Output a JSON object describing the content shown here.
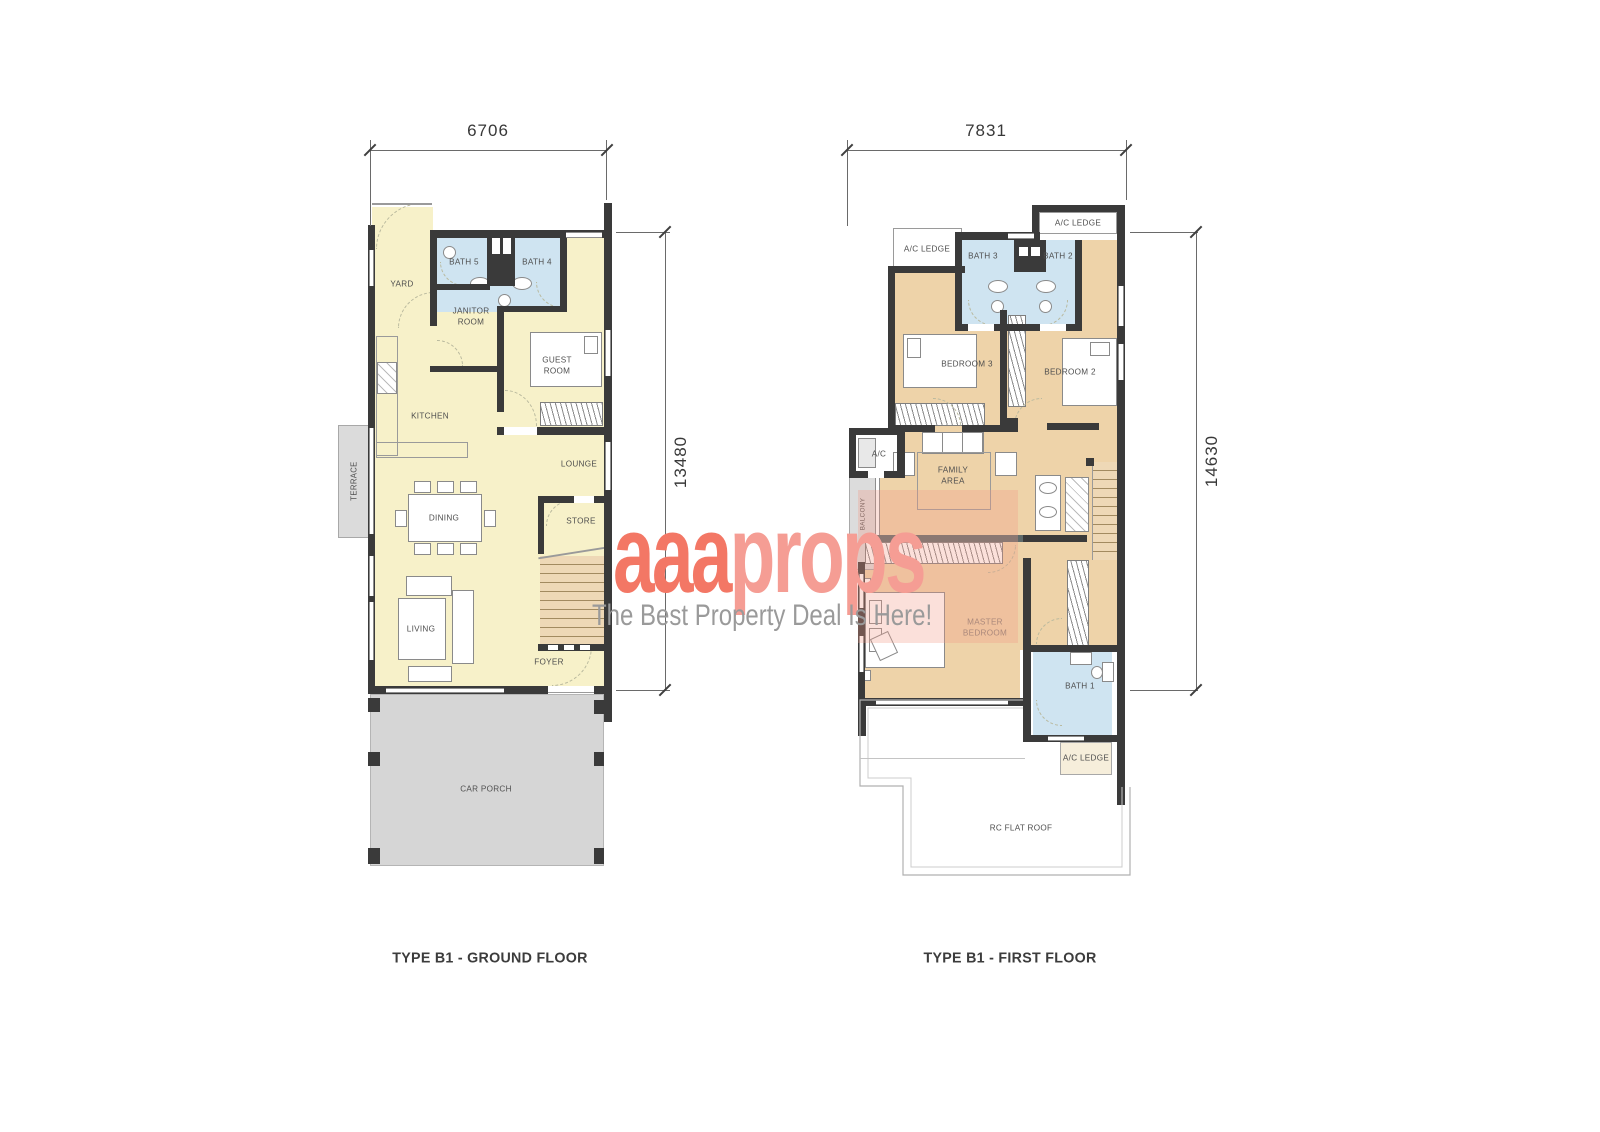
{
  "watermark": {
    "brand_bold": "aaa",
    "brand_light": "props",
    "tagline": "The Best Property Deal Is Here!",
    "brand_color": "#f37765",
    "brand_light_color": "#f59d94",
    "tagline_color": "#9a9a9a"
  },
  "ground_floor": {
    "title": "TYPE B1 - GROUND FLOOR",
    "width_dim": "6706",
    "height_dim": "13480",
    "rooms": {
      "yard": "YARD",
      "bath5": "BATH 5",
      "bath4": "BATH 4",
      "janitor": "JANITOR\nROOM",
      "guest": "GUEST\nROOM",
      "kitchen": "KITCHEN",
      "lounge": "LOUNGE",
      "terrace": "TERRACE",
      "dining": "DINING",
      "store": "STORE",
      "living": "LIVING",
      "foyer": "FOYER",
      "car_porch": "CAR PORCH"
    }
  },
  "first_floor": {
    "title": "TYPE B1 - FIRST FLOOR",
    "width_dim": "7831",
    "height_dim": "14630",
    "rooms": {
      "ac_ledge_top": "A/C LEDGE",
      "ac_ledge_left": "A/C LEDGE",
      "bath3": "BATH 3",
      "bath2": "BATH 2",
      "bedroom3": "BEDROOM 3",
      "bedroom2": "BEDROOM 2",
      "ac": "A/C",
      "balcony": "BALCONY",
      "family": "FAMILY\nAREA",
      "master": "MASTER\nBEDROOM",
      "bath1": "BATH 1",
      "ac_ledge_bottom": "A/C LEDGE",
      "rc_flat_roof": "RC FLAT ROOF"
    }
  },
  "colors": {
    "wall": "#3a3a3a",
    "ground_floor_fill": "#f7f1c9",
    "first_floor_fill": "#eed3a9",
    "bath_fill": "#cfe4f1",
    "porch_fill": "#d6d6d6"
  }
}
